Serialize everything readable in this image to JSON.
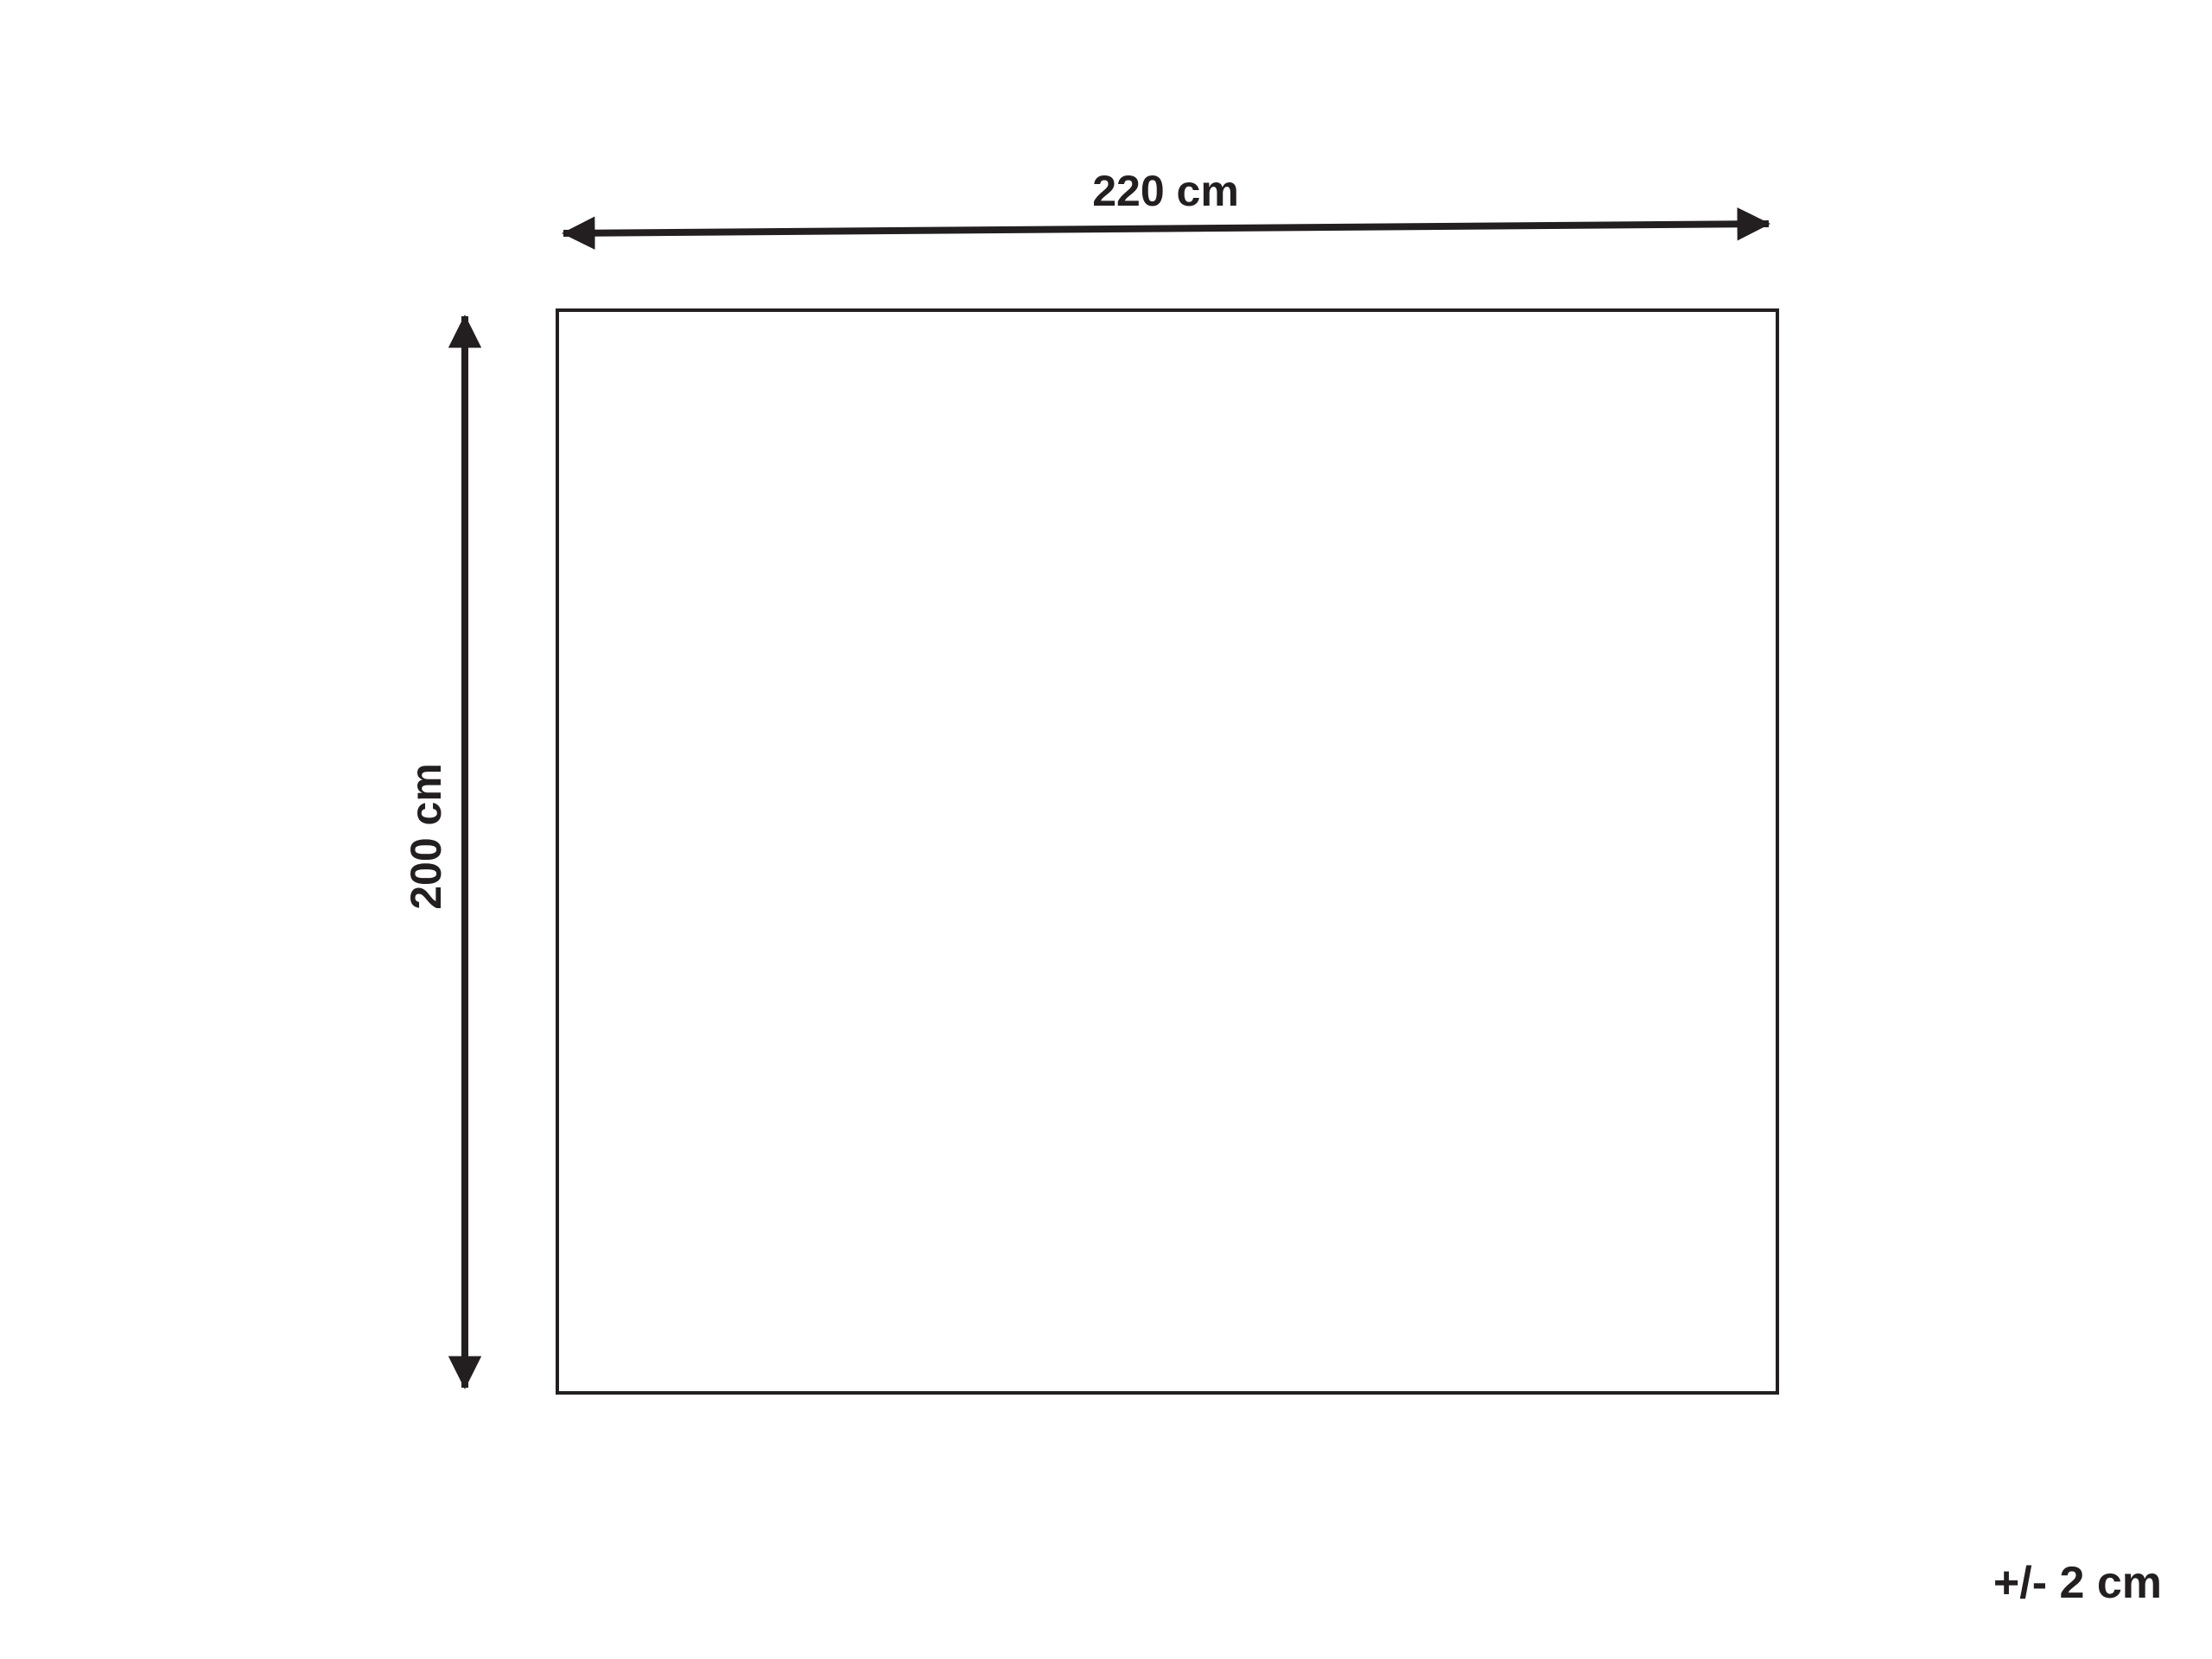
{
  "diagram": {
    "width_label": "220 cm",
    "height_label": "200 cm",
    "tolerance_label": "+/- 2 cm",
    "colors": {
      "ink": "#231f20",
      "background": "#ffffff"
    }
  }
}
